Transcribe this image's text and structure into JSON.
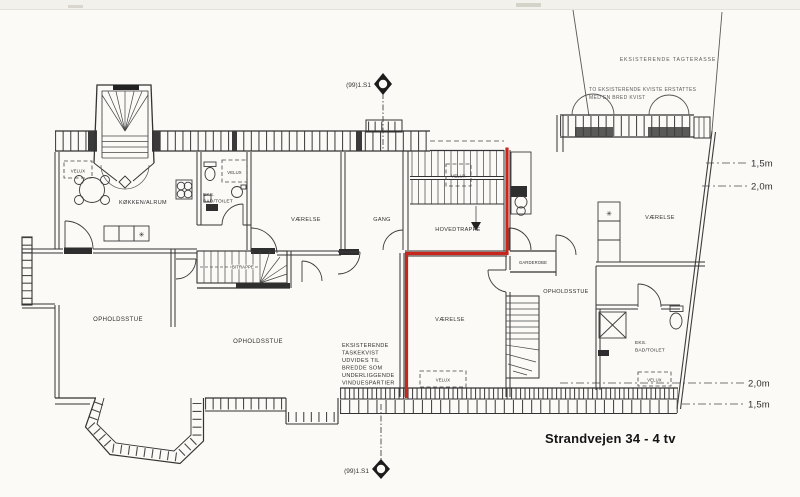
{
  "title": "Strandvejen 34 - 4 tv",
  "markers": {
    "section": "(99)1.S1"
  },
  "rooms": {
    "koekken_alrum": "KØKKEN/ALRUM",
    "eks": "EKS.",
    "bad_toilet": "BAD/TOILET",
    "vaerelse": "VÆRELSE",
    "gang": "GANG",
    "hovedtrappe": "HOVEDTRAPPE",
    "bitrappe": "BITRAPPE",
    "garderobe": "GARDEROBE",
    "opholdsstue": "OPHOLDSSTUE",
    "velux": "VELUX"
  },
  "notes": {
    "tagterrasse": "EKSISTERENDE TAGTERASSE",
    "kviste1": "TO EKSISTERENDE KVISTE ERSTATTES",
    "kviste2": "MED EN BRED KVIST",
    "taskekvist1": "EKSISTERENDE",
    "taskekvist2": "TASKEKVIST",
    "taskekvist3": "UDVIDES TIL",
    "taskekvist4": "BREDDE SOM",
    "taskekvist5": "UNDERLIGGENDE",
    "taskekvist6": "VINDUESPARTIER"
  },
  "dims": {
    "m15": "1,5m",
    "m20": "2,0m"
  },
  "symbols": {
    "burner_star": "✳"
  },
  "colors": {
    "ink": "#333333",
    "red": "#c8251d",
    "paper": "#fbfaf7"
  }
}
